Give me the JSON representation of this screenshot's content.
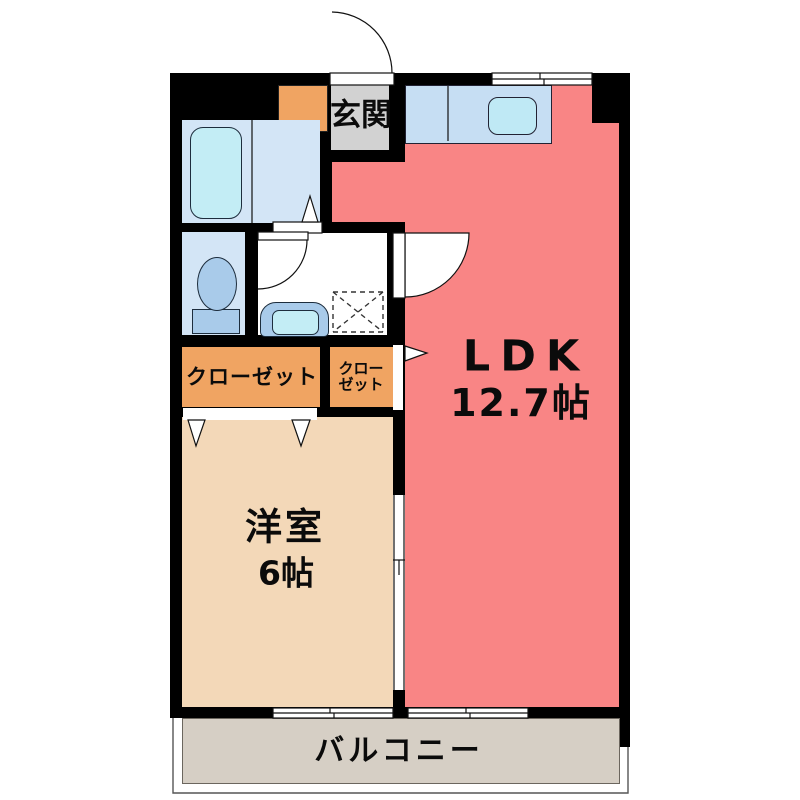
{
  "plan": {
    "entrance": {
      "label": "玄関"
    },
    "ldk": {
      "name": "LDK",
      "area": "12.7帖"
    },
    "western_room": {
      "name": "洋室",
      "area": "6帖"
    },
    "closet_large": {
      "label": "クローゼット"
    },
    "closet_small": {
      "line1": "クロー",
      "line2": "ゼット"
    },
    "balcony": {
      "label": "バルコニー"
    }
  },
  "colors": {
    "wall": "#000000",
    "ldk": "#F98585",
    "western_room": "#F3D8B8",
    "closet": "#F0A462",
    "entrance_floor": "#D2D2D2",
    "bathroom_floor": "#D3E5F6",
    "washroom_floor": "#FFFFFF",
    "balcony": "#D6CFC5",
    "counter": "#C6DEF3",
    "sink": "#BFE9F5",
    "tub": "#C3EDF5",
    "fixture_blue": "#A9CBEA"
  }
}
